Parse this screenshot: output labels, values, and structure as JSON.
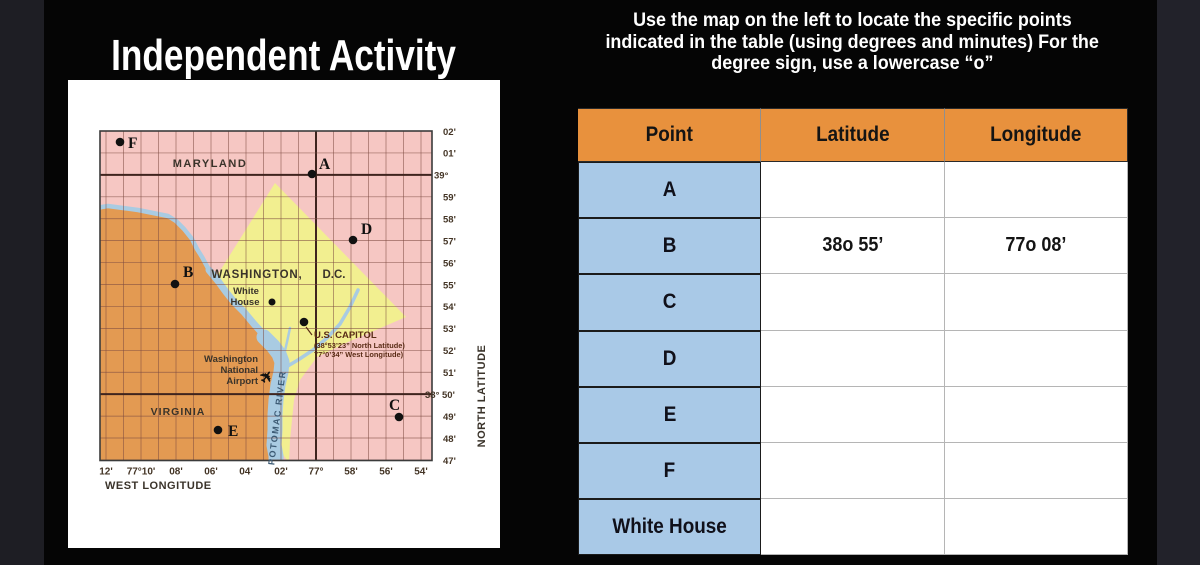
{
  "title": "Independent Activity",
  "instructions": {
    "lines": [
      "Use the map on the left to locate the specific points",
      "indicated in the table (using degrees and minutes) For the",
      "degree sign, use a lowercase “o”"
    ]
  },
  "table": {
    "headers": [
      "Point",
      "Latitude",
      "Longitude"
    ],
    "header_bg": "#E8913D",
    "point_col_bg": "#A9C9E7",
    "rows": [
      {
        "point": "A",
        "latitude": "",
        "longitude": ""
      },
      {
        "point": "B",
        "latitude": "38o 55’",
        "longitude": "77o 08’"
      },
      {
        "point": "C",
        "latitude": "",
        "longitude": ""
      },
      {
        "point": "D",
        "latitude": "",
        "longitude": ""
      },
      {
        "point": "E",
        "latitude": "",
        "longitude": ""
      },
      {
        "point": "F",
        "latitude": "",
        "longitude": ""
      },
      {
        "point": "White House",
        "latitude": "",
        "longitude": ""
      }
    ]
  },
  "map": {
    "colors": {
      "pink": "#F6C7C3",
      "yellow": "#F2EF90",
      "orange": "#E39A52",
      "river": "#A9CBE2",
      "grid": "#7d4a41",
      "degree": "#3f241e",
      "label": "#3a332a",
      "tick": "#443526",
      "capitol": "#5a2c16",
      "river_label": "#3c5a74",
      "dot": "#111111"
    },
    "x_axis": {
      "title": "WEST LONGITUDE",
      "ticks": [
        {
          "label": "12'",
          "k": 0
        },
        {
          "label": "77°10'",
          "k": 2
        },
        {
          "label": "08'",
          "k": 4
        },
        {
          "label": "06'",
          "k": 6
        },
        {
          "label": "04'",
          "k": 8
        },
        {
          "label": "02'",
          "k": 10
        },
        {
          "label": "77°",
          "k": 12,
          "major": true
        },
        {
          "label": "58'",
          "k": 14
        },
        {
          "label": "56'",
          "k": 16
        },
        {
          "label": "54'",
          "k": 18
        }
      ]
    },
    "y_axis": {
      "title": "NORTH LATITUDE",
      "ticks": [
        {
          "label": "02'",
          "k": 0
        },
        {
          "label": "01'",
          "k": 1
        },
        {
          "label": "39°",
          "k": 2,
          "major": true
        },
        {
          "label": "59'",
          "k": 3
        },
        {
          "label": "58'",
          "k": 4
        },
        {
          "label": "57'",
          "k": 5
        },
        {
          "label": "56'",
          "k": 6
        },
        {
          "label": "55'",
          "k": 7
        },
        {
          "label": "54'",
          "k": 8
        },
        {
          "label": "53'",
          "k": 9
        },
        {
          "label": "52'",
          "k": 10
        },
        {
          "label": "51'",
          "k": 11
        },
        {
          "label": "38° 50'",
          "k": 12,
          "major": true
        },
        {
          "label": "49'",
          "k": 13
        },
        {
          "label": "48'",
          "k": 14
        },
        {
          "label": "47'",
          "k": 15
        }
      ]
    },
    "labels": [
      {
        "name": "maryland-label",
        "text": "MARYLAND",
        "x": 142,
        "y": 87,
        "size": 11,
        "anchor": "middle",
        "ls": 1.5
      },
      {
        "name": "washington-label",
        "text": "WASHINGTON,",
        "x": 189,
        "y": 198,
        "size": 11.5,
        "anchor": "middle",
        "ls": 0.8
      },
      {
        "name": "dc-label",
        "text": "D.C.",
        "x": 266,
        "y": 198,
        "size": 11.5,
        "anchor": "middle"
      },
      {
        "name": "virginia-label",
        "text": "VIRGINIA",
        "x": 110,
        "y": 335,
        "size": 10.5,
        "anchor": "middle",
        "ls": 1
      },
      {
        "name": "white-house-label-line1",
        "text": "White",
        "x": 178,
        "y": 214,
        "size": 9.5,
        "anchor": "middle"
      },
      {
        "name": "white-house-label-line2",
        "text": "House",
        "x": 177,
        "y": 225,
        "size": 9.5,
        "anchor": "middle"
      },
      {
        "name": "us-capitol-label",
        "text": "U.S. CAPITOL",
        "x": 246,
        "y": 258,
        "size": 9.5,
        "anchor": "start",
        "color": "capitol"
      },
      {
        "name": "us-capitol-latitude-note",
        "text": "(38°53’23” North Latitude)",
        "x": 246,
        "y": 268,
        "size": 7.4,
        "anchor": "start",
        "color": "capitol"
      },
      {
        "name": "us-capitol-longitude-note",
        "text": "77°0’34” West Longitude)",
        "x": 246,
        "y": 277,
        "size": 7.4,
        "anchor": "start",
        "color": "capitol"
      },
      {
        "name": "airport-label-line1",
        "text": "Washington",
        "x": 190,
        "y": 282,
        "size": 9.5,
        "anchor": "end"
      },
      {
        "name": "airport-label-line2",
        "text": "National",
        "x": 190,
        "y": 293,
        "size": 9.5,
        "anchor": "end"
      },
      {
        "name": "airport-label-line3",
        "text": "Airport",
        "x": 190,
        "y": 304,
        "size": 9.5,
        "anchor": "end"
      },
      {
        "name": "airplane-icon",
        "text": "✈",
        "x": 203,
        "y": 300,
        "size": 16,
        "anchor": "middle",
        "rotate": -55,
        "color": "dot"
      },
      {
        "name": "potomac-river-label",
        "text": "POTOMAC RIVER",
        "x": 212,
        "y": 338,
        "size": 9,
        "anchor": "middle",
        "rotate": -83,
        "ls": 1.5,
        "color": "river_label"
      },
      {
        "name": "west-longitude-label",
        "text": "WEST LONGITUDE",
        "x": 37,
        "y": 409,
        "size": 11,
        "anchor": "start",
        "ls": 0.5
      },
      {
        "name": "north-latitude-label",
        "text": "NORTH LATITUDE",
        "x": 417,
        "y": 316,
        "size": 11,
        "anchor": "middle",
        "rotate": -90,
        "ls": 0.5
      }
    ],
    "points": [
      {
        "id": "F",
        "dot": [
          52,
          62
        ],
        "label": [
          60,
          68
        ]
      },
      {
        "id": "A",
        "dot": [
          244,
          94
        ],
        "label": [
          251,
          89
        ]
      },
      {
        "id": "D",
        "dot": [
          285,
          160
        ],
        "label": [
          293,
          154
        ]
      },
      {
        "id": "B",
        "dot": [
          107,
          204
        ],
        "label": [
          115,
          197
        ]
      },
      {
        "id": "E",
        "dot": [
          150,
          350
        ],
        "label": [
          160,
          356
        ]
      },
      {
        "id": "C",
        "dot": [
          331,
          337
        ],
        "label": [
          321,
          330
        ]
      }
    ],
    "white_house_dot": [
      204,
      222
    ],
    "capitol_dot": [
      236,
      242
    ]
  }
}
